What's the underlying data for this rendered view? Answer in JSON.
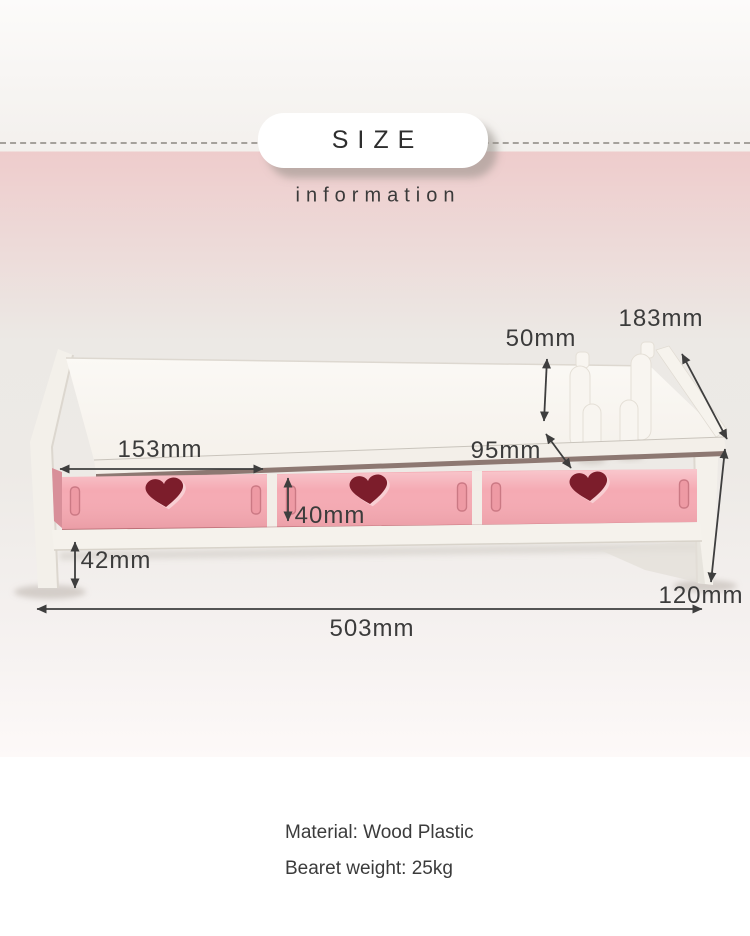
{
  "header": {
    "badge_label": "SIZE",
    "subtitle": "information"
  },
  "dimensions": {
    "holder_width": "183mm",
    "holder_height": "50mm",
    "right_section_depth": "95mm",
    "drawer_width": "153mm",
    "drawer_height": "40mm",
    "under_clearance": "42mm",
    "side_height": "120mm",
    "total_length": "503mm"
  },
  "specs": {
    "material": "Material: Wood Plastic",
    "weight": "Bearet weight: 25kg"
  },
  "colors": {
    "background": "#edeae6",
    "panel_white": "#f6f3ee",
    "drawer_pink": "#f5aab3",
    "heart_maroon": "#7c1d2b",
    "text_dark": "#3b3b3b",
    "arrow": "#3e3e3e"
  }
}
